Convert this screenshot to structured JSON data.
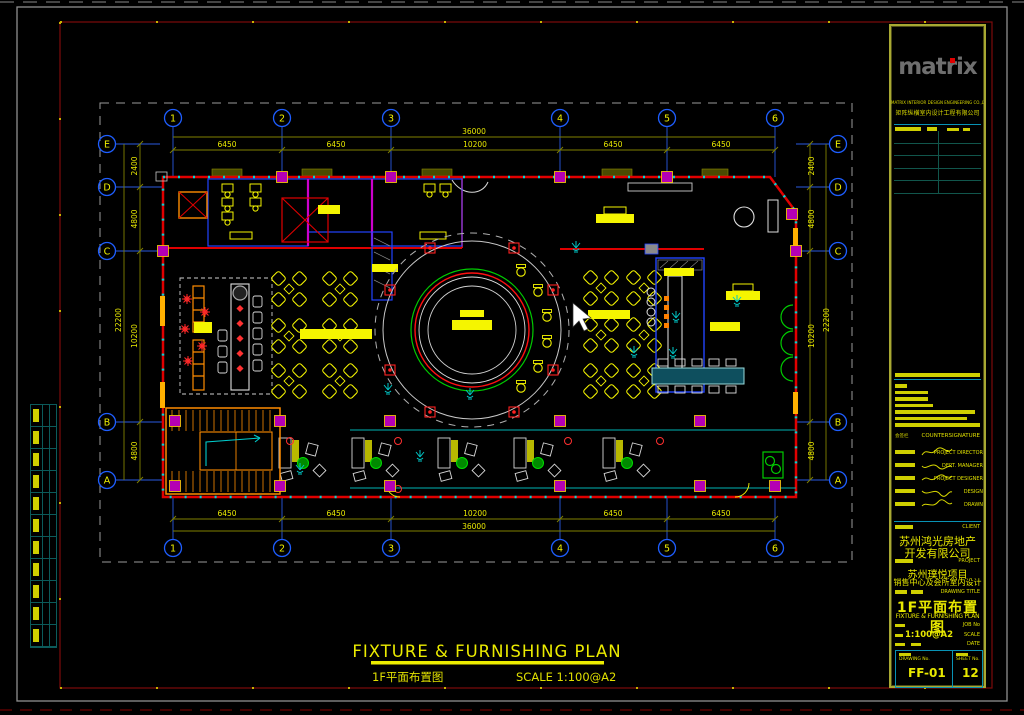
{
  "window": {
    "background": "#000000"
  },
  "sheet": {
    "outer_border_color": "#8f8f8f",
    "inner_border_color": "#7d0a0a",
    "accent_yellow": "#f5f500",
    "wall_red": "#e00000",
    "grid_blue": "#2a5ae0",
    "cad_cyan": "#00d4d4"
  },
  "grid": {
    "cols": [
      "1",
      "2",
      "3",
      "4",
      "5",
      "6"
    ],
    "rows": [
      "E",
      "D",
      "C",
      "B",
      "A"
    ]
  },
  "dims": {
    "h_total": "36000",
    "h_segments": [
      "6450",
      "6450",
      "10200",
      "6450",
      "6450"
    ],
    "v_total": "22200",
    "v_segments": [
      "2400",
      "4800",
      "10200",
      "4800"
    ]
  },
  "plan_caption": {
    "title": "FIXTURE & FURNISHING PLAN",
    "subtitle_cn": "1F平面布置图",
    "scale": "SCALE  1:100@A2"
  },
  "title_block": {
    "logo": "matrix",
    "company_en": "MATRIX INTERIOR DESIGN ENGINEERING CO.,LTD",
    "company_cn": "矩阵纵横室内设计工程有限公司",
    "countersignature_label": "COUNTERSIGNATURE",
    "countersign_cn": "会签栏",
    "sign_rows": [
      {
        "label": "PROJECT DIRECTOR"
      },
      {
        "label": "DEPT. MANAGER"
      },
      {
        "label": "PROJECT DESIGNER"
      },
      {
        "label": "DESIGN"
      },
      {
        "label": "DRAWN"
      }
    ],
    "client_label": "CLIENT",
    "client_line1": "苏州鸿光房地产",
    "client_line2": "开发有限公司",
    "project_label": "PROJECT",
    "project_line1": "苏州璞悦项目",
    "project_line2": "销售中心及会所室内设计",
    "drawing_title_label": "DRAWING TITLE",
    "drawing_title_cn": "1F平面布置图",
    "drawing_title_en": "FIXTURE & FURNISHING PLAN",
    "job_label": "JOB No",
    "scale_label": "SCALE",
    "scale_value": "1:100@A2",
    "date_label": "DATE",
    "drawing_no_label": "DRAWING No.",
    "drawing_no": "FF-01",
    "sheet_no_label": "SHEET No.",
    "sheet_no": "12"
  }
}
